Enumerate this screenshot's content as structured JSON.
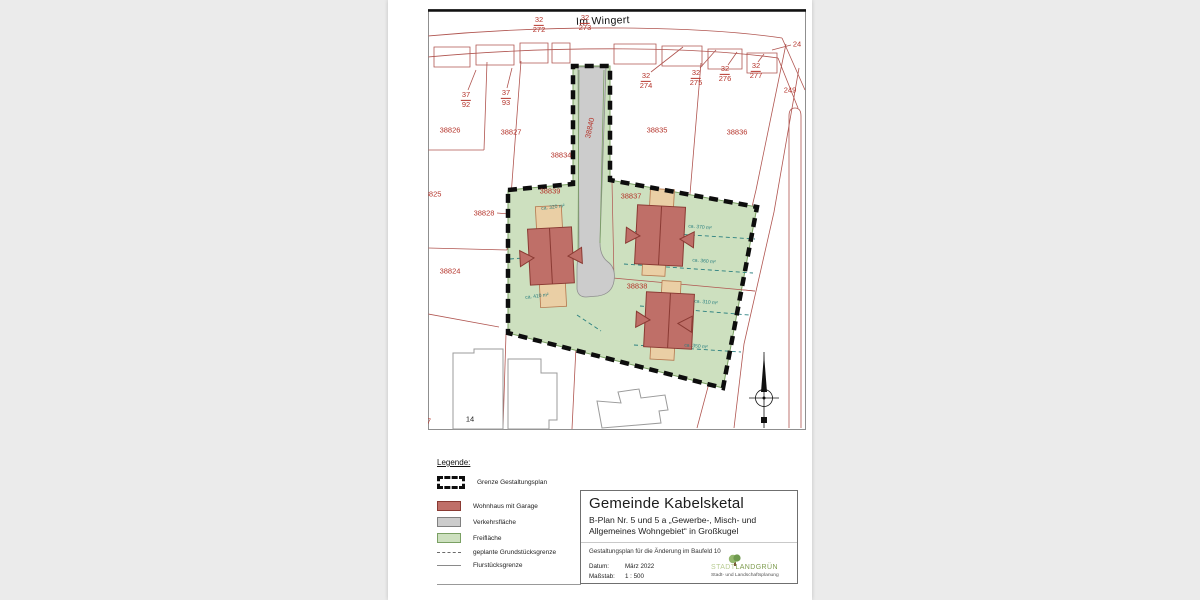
{
  "colors": {
    "canvas_bg": "#ebebeb",
    "cadastral_red": "#b05550",
    "label_red": "#b5352c",
    "teal": "#2a7f7f",
    "green_fill": "#cde0bf",
    "green_edge": "#7aa063",
    "road_fill": "#cccccc",
    "house_fill": "#bf6f68",
    "house_edge": "#8a3a33",
    "garage_fill": "#eacfa5",
    "garage_edge": "#b5764d",
    "logo_light": "#b8cc92",
    "logo_dark": "#7e9c4f"
  },
  "map": {
    "street_name": "Im Wingert",
    "fraction_labels": [
      {
        "num": "32",
        "den": "272",
        "x": 539,
        "y": 25
      },
      {
        "num": "32",
        "den": "273",
        "x": 585,
        "y": 23
      },
      {
        "num": "37",
        "den": "92",
        "x": 466,
        "y": 100
      },
      {
        "num": "37",
        "den": "93",
        "x": 506,
        "y": 98
      },
      {
        "num": "32",
        "den": "274",
        "x": 646,
        "y": 81
      },
      {
        "num": "32",
        "den": "275",
        "x": 696,
        "y": 78
      },
      {
        "num": "32",
        "den": "276",
        "x": 725,
        "y": 74
      },
      {
        "num": "32",
        "den": "277",
        "x": 756,
        "y": 71
      }
    ],
    "parcel_labels": [
      {
        "text": "38826",
        "x": 450,
        "y": 130
      },
      {
        "text": "38827",
        "x": 511,
        "y": 132
      },
      {
        "text": "38834",
        "x": 561,
        "y": 155
      },
      {
        "text": "38835",
        "x": 657,
        "y": 130
      },
      {
        "text": "38836",
        "x": 737,
        "y": 132
      },
      {
        "text": "38825",
        "x": 431,
        "y": 194
      },
      {
        "text": "38828",
        "x": 484,
        "y": 213
      },
      {
        "text": "38824",
        "x": 450,
        "y": 271
      },
      {
        "text": "38840",
        "x": 590,
        "y": 128,
        "rot": -78
      },
      {
        "text": "38839",
        "x": 550,
        "y": 191
      },
      {
        "text": "38837",
        "x": 631,
        "y": 196
      },
      {
        "text": "38838",
        "x": 637,
        "y": 286
      },
      {
        "text": "249",
        "x": 790,
        "y": 90
      },
      {
        "text": "24",
        "x": 797,
        "y": 44
      },
      {
        "text": "7",
        "x": 429,
        "y": 421
      },
      {
        "text": "14",
        "x": 470,
        "y": 419,
        "color": "black"
      }
    ],
    "area_labels": [
      {
        "text": "ca. 320 m²",
        "x": 553,
        "y": 208,
        "rot": -7
      },
      {
        "text": "ca. 410 m²",
        "x": 537,
        "y": 297,
        "rot": -7
      },
      {
        "text": "ca. 370 m²",
        "x": 700,
        "y": 228,
        "rot": 5
      },
      {
        "text": "ca. 360 m²",
        "x": 704,
        "y": 262,
        "rot": 5
      },
      {
        "text": "ca. 310 m²",
        "x": 706,
        "y": 303,
        "rot": 5
      },
      {
        "text": "ca. 350 m²",
        "x": 696,
        "y": 347,
        "rot": 5
      }
    ]
  },
  "legend": {
    "title": "Legende:",
    "items": [
      {
        "type": "boundary",
        "label": "Grenze Gestaltungsplan"
      },
      {
        "type": "house",
        "label": "Wohnhaus mit Garage"
      },
      {
        "type": "road",
        "label": "Verkehrsfläche"
      },
      {
        "type": "open",
        "label": "Freifläche"
      },
      {
        "type": "dashed",
        "label": "geplante Grundstücksgrenze"
      },
      {
        "type": "solid",
        "label": "Flurstücksgrenze"
      }
    ]
  },
  "title_block": {
    "municipality": "Gemeinde Kabelsketal",
    "plan_line1": "B-Plan Nr. 5 und 5 a „Gewerbe-, Misch- und",
    "plan_line2": "Allgemeines Wohngebiet“ in Großkugel",
    "subtitle": "Gestaltungsplan für die Änderung im Baufeld 10",
    "date_label": "Datum:",
    "date_value": "März 2022",
    "scale_label": "Maßstab:",
    "scale_value": "1 : 500",
    "logo_text_light": "STADT",
    "logo_text_dark": "LANDGRÜN",
    "logo_subtitle": "Stadt- und Landschaftsplanung"
  }
}
